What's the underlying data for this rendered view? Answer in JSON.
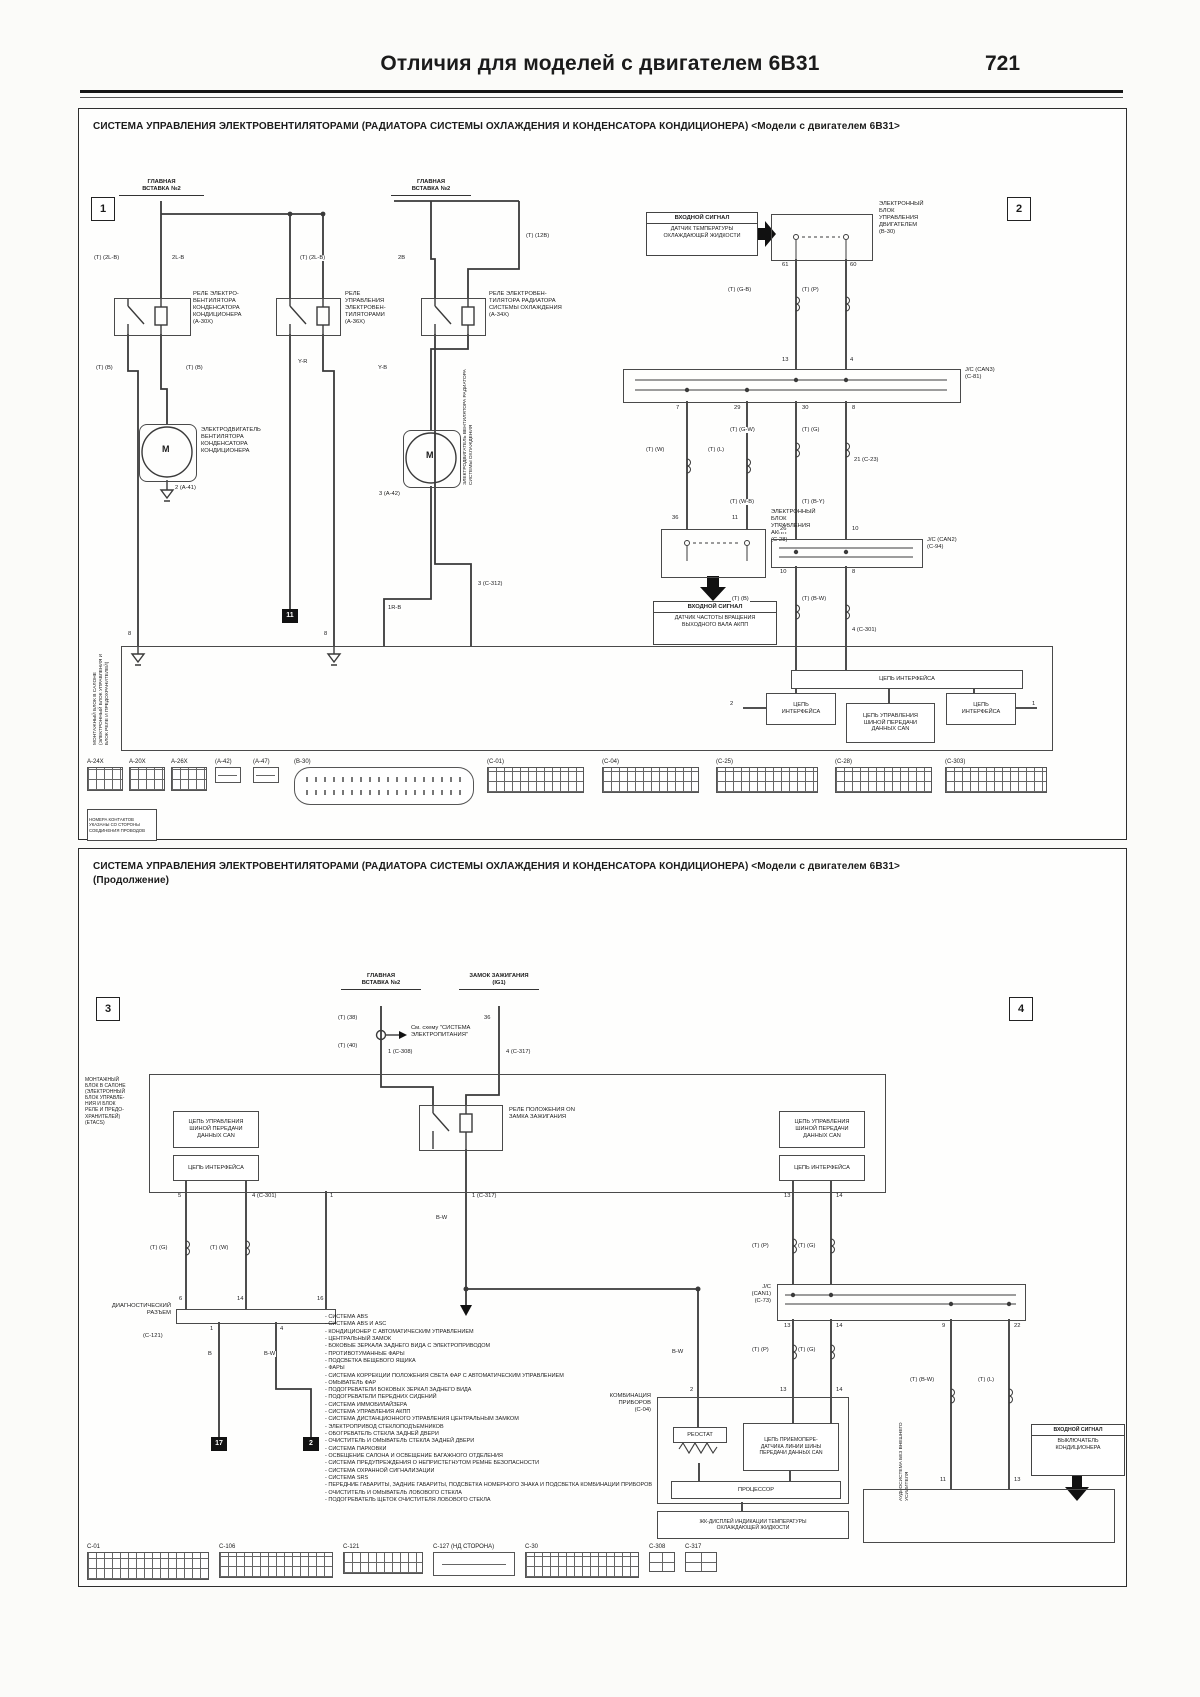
{
  "page": {
    "header_title": "Отличия для моделей с двигателем 6В31",
    "page_number": "721"
  },
  "colors": {
    "line": "#3a3a3a",
    "text": "#1b1b1b",
    "paper": "#fbfbf9"
  },
  "panel1": {
    "title": "СИСТЕМА УПРАВЛЕНИЯ ЭЛЕКТРОВЕНТИЛЯТОРАМИ (РАДИАТОРА СИСТЕМЫ ОХЛАЖДЕНИЯ И КОНДЕНСАТОРА КОНДИЦИОНЕРА) <Модели с двигателем 6В31>",
    "marker_left": "1",
    "marker_right": "2",
    "fusible_link": "ГЛАВНАЯ\nВСТАВКА №2",
    "relay1": "РЕЛЕ ЭЛЕКТРО-\nВЕНТИЛЯТОРА\nКОНДЕНСАТОРА\nКОНДИЦИОНЕРА\n(A-30X)",
    "relay2": "РЕЛЕ\nУПРАВЛЕНИЯ\nЭЛЕКТРОВЕН-\nТИЛЯТОРАМИ\n(A-36X)",
    "relay3": "РЕЛЕ ЭЛЕКТРОВЕН-\nТИЛЯТОРА РАДИАТОРА\nСИСТЕМЫ ОХЛАЖДЕНИЯ\n(A-34X)",
    "motor_symbol": "M",
    "motor1": "ЭЛЕКТРОДВИГАТЕЛЬ\nВЕНТИЛЯТОРА\nКОНДЕНСАТОРА\nКОНДИЦИОНЕРА",
    "motor1_pin": "2 (A-41)",
    "motor2_vert": "ЭЛЕКТРОДВИГАТЕЛЬ ВЕНТИЛЯТОРА РАДИАТОРА СИСТЕМЫ ОХЛАЖДЕНИЯ",
    "motor2_pin": "3 (A-42)",
    "input1_title": "ВХОДНОЙ СИГНАЛ",
    "input1_body": "ДАТЧИК ТЕМПЕРАТУРЫ\nОХЛАЖДАЮЩЕЙ ЖИДКОСТИ",
    "ecu_engine": "ЭЛЕКТРОННЫЙ\nБЛОК\nУПРАВЛЕНИЯ\nДВИГАТЕЛЕМ\n(B-30)",
    "jc_can3": "J/C (CAN3)\n(C-81)",
    "ecu_at": "ЭЛЕКТРОННЫЙ\nБЛОК\nУПРАВЛЕНИЯ\nАКПП\n(C-28)",
    "input2_title": "ВХОДНОЙ СИГНАЛ",
    "input2_body": "ДАТЧИК ЧАСТОТЫ ВРАЩЕНИЯ\nВЫХОДНОГО ВАЛА АКПП",
    "jc_can2": "J/C (CAN2)\n(C-94)",
    "etacs_vert": "МОНТАЖНЫЙ БЛОК В САЛОНЕ (ЭЛЕКТРОННЫЙ БЛОК УПРАВЛЕНИЯ И БЛОК РЕЛЕ И ПРЕДОХРАНИТЕЛЕЙ)",
    "iface_wide": "ЦЕПЬ ИНТЕРФЕЙСА",
    "iface_left": "ЦЕПЬ\nИНТЕРФЕЙСА",
    "can_ctrl": "ЦЕПЬ УПРАВЛЕНИЯ\nШИНОЙ ПЕРЕДАЧИ\nДАННЫХ CAN",
    "iface_right": "ЦЕПЬ\nИНТЕРФЕЙСА",
    "sq11": "11",
    "note": "НОМЕРА КОНТАКТОВ УКАЗАНЫ СО СТОРОНЫ СОЕДИНЕНИЯ ПРОВОДОВ",
    "wire_codes": [
      {
        "t": "(Т) (2L-B)",
        "x": 14,
        "y": 146
      },
      {
        "t": "2L-B",
        "x": 92,
        "y": 146
      },
      {
        "t": "(Т) (2L-B)",
        "x": 220,
        "y": 146
      },
      {
        "t": "2B",
        "x": 318,
        "y": 146
      },
      {
        "t": "(Т) (12B)",
        "x": 446,
        "y": 124
      },
      {
        "t": "Y-R",
        "x": 218,
        "y": 250
      },
      {
        "t": "(Т) (B)",
        "x": 16,
        "y": 256
      },
      {
        "t": "(Т) (B)",
        "x": 106,
        "y": 256
      },
      {
        "t": "Y-B",
        "x": 298,
        "y": 256
      },
      {
        "t": "1R-B",
        "x": 308,
        "y": 496
      },
      {
        "t": "3 (C-312)",
        "x": 398,
        "y": 472
      },
      {
        "t": "(Т) (G-B)",
        "x": 648,
        "y": 178
      },
      {
        "t": "(Т) (P)",
        "x": 722,
        "y": 178
      },
      {
        "t": "(Т) (W)",
        "x": 566,
        "y": 338
      },
      {
        "t": "(Т) (L)",
        "x": 628,
        "y": 338
      },
      {
        "t": "(Т) (G-W)",
        "x": 650,
        "y": 318
      },
      {
        "t": "(Т) (G)",
        "x": 722,
        "y": 318
      },
      {
        "t": "21 (C-23)",
        "x": 774,
        "y": 348
      },
      {
        "t": "(Т) (W-B)",
        "x": 650,
        "y": 390
      },
      {
        "t": "(Т) (B-Y)",
        "x": 722,
        "y": 390
      },
      {
        "t": "(Т) (B)",
        "x": 652,
        "y": 487
      },
      {
        "t": "(Т) (B-W)",
        "x": 722,
        "y": 487
      },
      {
        "t": "4 (C-301)",
        "x": 772,
        "y": 518
      }
    ],
    "pins": [
      {
        "t": "61",
        "x": 702,
        "y": 153
      },
      {
        "t": "60",
        "x": 770,
        "y": 153
      },
      {
        "t": "13",
        "x": 702,
        "y": 248
      },
      {
        "t": "4",
        "x": 770,
        "y": 248
      },
      {
        "t": "7",
        "x": 596,
        "y": 296
      },
      {
        "t": "29",
        "x": 654,
        "y": 296
      },
      {
        "t": "30",
        "x": 722,
        "y": 296
      },
      {
        "t": "8",
        "x": 772,
        "y": 296
      },
      {
        "t": "36",
        "x": 592,
        "y": 406
      },
      {
        "t": "11",
        "x": 652,
        "y": 406
      },
      {
        "t": "26",
        "x": 700,
        "y": 417
      },
      {
        "t": "10",
        "x": 772,
        "y": 417
      },
      {
        "t": "10",
        "x": 700,
        "y": 460
      },
      {
        "t": "8",
        "x": 772,
        "y": 460
      },
      {
        "t": "8",
        "x": 48,
        "y": 522
      },
      {
        "t": "8",
        "x": 244,
        "y": 522
      },
      {
        "t": "2",
        "x": 650,
        "y": 592
      },
      {
        "t": "1",
        "x": 952,
        "y": 592
      }
    ],
    "connectors": [
      {
        "label": "A-24X",
        "x": 8,
        "w": 34,
        "h": 22,
        "type": "grid"
      },
      {
        "label": "A-20X",
        "x": 50,
        "w": 34,
        "h": 22,
        "type": "grid"
      },
      {
        "label": "A-26X",
        "x": 92,
        "w": 34,
        "h": 22,
        "type": "grid"
      },
      {
        "label": "(A-42)",
        "x": 136,
        "w": 24,
        "h": 14,
        "type": "small"
      },
      {
        "label": "(A-47)",
        "x": 174,
        "w": 24,
        "h": 14,
        "type": "small"
      },
      {
        "label": "(B-30)",
        "x": 215,
        "w": 178,
        "h": 36,
        "type": "oval"
      },
      {
        "label": "(C-01)",
        "x": 408,
        "w": 95,
        "h": 24,
        "type": "grid"
      },
      {
        "label": "(C-04)",
        "x": 523,
        "w": 95,
        "h": 24,
        "type": "grid"
      },
      {
        "label": "(C-25)",
        "x": 637,
        "w": 100,
        "h": 24,
        "type": "grid"
      },
      {
        "label": "(C-28)",
        "x": 756,
        "w": 95,
        "h": 24,
        "type": "grid"
      },
      {
        "label": "(C-303)",
        "x": 866,
        "w": 100,
        "h": 24,
        "type": "grid"
      }
    ]
  },
  "panel2": {
    "title": "СИСТЕМА УПРАВЛЕНИЯ ЭЛЕКТРОВЕНТИЛЯТОРАМИ (РАДИАТОРА СИСТЕМЫ ОХЛАЖДЕНИЯ И КОНДЕНСАТОРА КОНДИЦИОНЕРА) <Модели с двигателем 6В31>",
    "subtitle": "(Продолжение)",
    "marker_left": "3",
    "marker_right": "4",
    "fusible_link": "ГЛАВНАЯ\nВСТАВКА №2",
    "ignition": "ЗАМОК ЗАЖИГАНИЯ\n(IG1)",
    "see_note": "См. схему \"СИСТЕМА\nЭЛЕКТРОПИТАНИЯ\"",
    "etacs": "МОНТАЖНЫЙ\nБЛОК В САЛОНЕ\n(ЭЛЕКТРОННЫЙ\nБЛОК УПРАВЛЕ-\nНИЯ И БЛОК\nРЕЛЕ И ПРЕДО-\nХРАНИТЕЛЕЙ)\n(ETACS)",
    "can_ctrl_left": "ЦЕПЬ УПРАВЛЕНИЯ\nШИНОЙ ПЕРЕДАЧИ\nДАННЫХ CAN",
    "iface_left": "ЦЕПЬ ИНТЕРФЕЙСА",
    "can_ctrl_right": "ЦЕПЬ УПРАВЛЕНИЯ\nШИНОЙ ПЕРЕДАЧИ\nДАННЫХ CAN",
    "iface_right": "ЦЕПЬ ИНТЕРФЕЙСА",
    "relay_on": "РЕЛЕ ПОЛОЖЕНИЯ ON\nЗАМКА ЗАЖИГАНИЯ",
    "diag_label": "ДИАГНОСТИЧЕСКИЙ\nРАЗЪЕМ",
    "diag_conn": "(C-121)",
    "sq17": "17",
    "sq2": "2",
    "jc_can1": "J/C\n(CAN1)\n(C-73)",
    "cluster": "КОМБИНАЦИЯ\nПРИБОРОВ\n(C-04)",
    "rheostat": "РЕОСТАТ",
    "transceiver": "ЦЕПЬ ПРИЕМОПЕРЕ-\nДАТЧИКА ЛИНИИ ШИНЫ\nПЕРЕДАЧИ ДАННЫХ CAN",
    "processor": "ПРОЦЕССОР",
    "lcd": "ЖК-ДИСПЛЕЙ ИНДИКАЦИИ ТЕМПЕРАТУРЫ\nОХЛАЖДАЮЩЕЙ ЖИДКОСТИ",
    "audio_vert": "АУДИОСИСТЕМА БЕЗ ВНЕШНЕГО УСИЛИТЕЛЯ",
    "input_ac_title": "ВХОДНОЙ СИГНАЛ",
    "input_ac_body": "ВЫКЛЮЧАТЕЛЬ\nКОНДИЦИОНЕРА",
    "systems": [
      "СИСТЕМА ABS",
      "СИСТЕМА ABS И ASC",
      "КОНДИЦИОНЕР С АВТОМАТИЧЕСКИМ УПРАВЛЕНИЕМ",
      "ЦЕНТРАЛЬНЫЙ ЗАМОК",
      "БОКОВЫЕ ЗЕРКАЛА ЗАДНЕГО ВИДА С ЭЛЕКТРОПРИВОДОМ",
      "ПРОТИВОТУМАННЫЕ ФАРЫ",
      "ПОДСВЕТКА ВЕЩЕВОГО ЯЩИКА",
      "ФАРЫ",
      "СИСТЕМА КОРРЕКЦИИ ПОЛОЖЕНИЯ СВЕТА ФАР С АВТОМАТИЧЕСКИМ УПРАВЛЕНИЕМ",
      "ОМЫВАТЕЛЬ ФАР",
      "ПОДОГРЕВАТЕЛИ БОКОВЫХ ЗЕРКАЛ ЗАДНЕГО ВИДА",
      "ПОДОГРЕВАТЕЛИ ПЕРЕДНИХ СИДЕНИЙ",
      "СИСТЕМА ИММОБИЛАЙЗЕРА",
      "СИСТЕМА УПРАВЛЕНИЯ АКПП",
      "СИСТЕМА ДИСТАНЦИОННОГО УПРАВЛЕНИЯ ЦЕНТРАЛЬНЫМ ЗАМКОМ",
      "ЭЛЕКТРОПРИВОД СТЕКЛОПОДЪЕМНИКОВ",
      "ОБОГРЕВАТЕЛЬ СТЕКЛА ЗАДНЕЙ ДВЕРИ",
      "ОЧИСТИТЕЛЬ И ОМЫВАТЕЛЬ СТЕКЛА ЗАДНЕЙ ДВЕРИ",
      "СИСТЕМА ПАРКОВКИ",
      "ОСВЕЩЕНИЕ САЛОНА И ОСВЕЩЕНИЕ БАГАЖНОГО ОТДЕЛЕНИЯ",
      "СИСТЕМА ПРЕДУПРЕЖДЕНИЯ О НЕПРИСТЕГНУТОМ РЕМНЕ БЕЗОПАСНОСТИ",
      "СИСТЕМА ОХРАННОЙ СИГНАЛИЗАЦИИ",
      "СИСТЕМА SRS",
      "ПЕРЕДНИЕ ГАБАРИТЫ, ЗАДНИЕ ГАБАРИТЫ, ПОДСВЕТКА НОМЕРНОГО ЗНАКА И ПОДСВЕТКА КОМБИНАЦИИ ПРИБОРОВ",
      "ОЧИСТИТЕЛЬ И ОМЫВАТЕЛЬ ЛОБОВОГО СТЕКЛА",
      "ПОДОГРЕВАТЕЛЬ ЩЕТОК ОЧИСТИТЕЛЯ ЛОБОВОГО СТЕКЛА"
    ],
    "wire_codes": [
      {
        "t": "(Т) (38)",
        "x": 258,
        "y": 166
      },
      {
        "t": "(Т) (40)",
        "x": 258,
        "y": 194
      },
      {
        "t": "36",
        "x": 404,
        "y": 166
      },
      {
        "t": "B-W",
        "x": 356,
        "y": 366
      },
      {
        "t": "(Т) (G)",
        "x": 70,
        "y": 396
      },
      {
        "t": "(Т) (W)",
        "x": 130,
        "y": 396
      },
      {
        "t": "B",
        "x": 128,
        "y": 502
      },
      {
        "t": "B-W",
        "x": 184,
        "y": 502
      },
      {
        "t": "(Т) (P)",
        "x": 672,
        "y": 394
      },
      {
        "t": "(Т) (G)",
        "x": 718,
        "y": 394
      },
      {
        "t": "(Т) (P)",
        "x": 672,
        "y": 498
      },
      {
        "t": "(Т) (G)",
        "x": 718,
        "y": 498
      },
      {
        "t": "(Т) (B-W)",
        "x": 830,
        "y": 528
      },
      {
        "t": "(Т) (L)",
        "x": 898,
        "y": 528
      },
      {
        "t": "B-W",
        "x": 592,
        "y": 500
      }
    ],
    "pins": [
      {
        "t": "1 (C-308)",
        "x": 308,
        "y": 200
      },
      {
        "t": "4 (C-317)",
        "x": 426,
        "y": 200
      },
      {
        "t": "1 (C-317)",
        "x": 392,
        "y": 344
      },
      {
        "t": "5",
        "x": 98,
        "y": 344
      },
      {
        "t": "4 (C-301)",
        "x": 172,
        "y": 344
      },
      {
        "t": "1",
        "x": 250,
        "y": 344
      },
      {
        "t": "6",
        "x": 99,
        "y": 447
      },
      {
        "t": "14",
        "x": 157,
        "y": 447
      },
      {
        "t": "16",
        "x": 237,
        "y": 447
      },
      {
        "t": "1",
        "x": 130,
        "y": 477
      },
      {
        "t": "4",
        "x": 200,
        "y": 477
      },
      {
        "t": "13",
        "x": 704,
        "y": 344
      },
      {
        "t": "14",
        "x": 756,
        "y": 344
      },
      {
        "t": "13",
        "x": 704,
        "y": 474
      },
      {
        "t": "14",
        "x": 756,
        "y": 474
      },
      {
        "t": "9",
        "x": 862,
        "y": 474
      },
      {
        "t": "22",
        "x": 934,
        "y": 474
      },
      {
        "t": "2",
        "x": 610,
        "y": 538
      },
      {
        "t": "13",
        "x": 700,
        "y": 538
      },
      {
        "t": "14",
        "x": 756,
        "y": 538
      },
      {
        "t": "11",
        "x": 860,
        "y": 628
      },
      {
        "t": "13",
        "x": 934,
        "y": 628
      }
    ],
    "connectors": [
      {
        "label": "C-01",
        "x": 8,
        "w": 120,
        "h": 26,
        "type": "grid"
      },
      {
        "label": "C-106",
        "x": 140,
        "w": 112,
        "h": 24,
        "type": "grid"
      },
      {
        "label": "C-121",
        "x": 264,
        "w": 78,
        "h": 20,
        "type": "grid"
      },
      {
        "label": "C-127 (НД СТОРОНА)",
        "x": 354,
        "w": 80,
        "h": 22,
        "type": "small"
      },
      {
        "label": "C-30",
        "x": 446,
        "w": 112,
        "h": 24,
        "type": "grid"
      },
      {
        "label": "C-308",
        "x": 570,
        "w": 24,
        "h": 18,
        "type": "sq2"
      },
      {
        "label": "C-317",
        "x": 606,
        "w": 30,
        "h": 18,
        "type": "sq2"
      }
    ]
  }
}
